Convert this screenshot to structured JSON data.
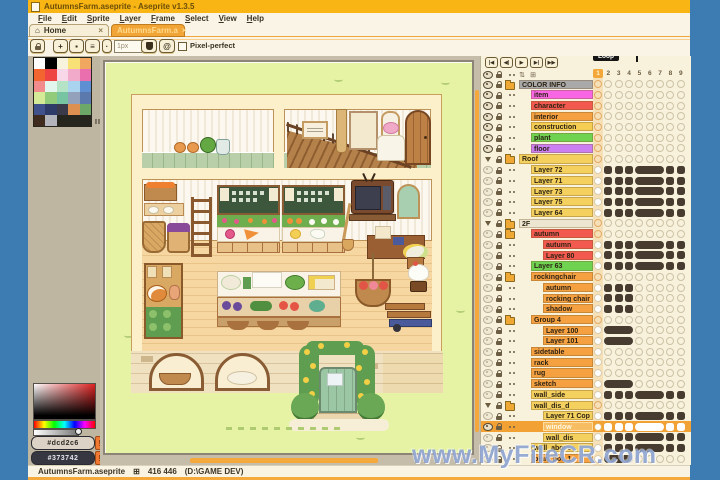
{
  "window": {
    "title": "AutumnsFarm.aseprite - Aseprite v1.3.5"
  },
  "menu": {
    "items": [
      "File",
      "Edit",
      "Sprite",
      "Layer",
      "Frame",
      "Select",
      "View",
      "Help"
    ]
  },
  "tabs": {
    "home_label": "Home",
    "home_icon": "⌂",
    "file_label": "AutumnsFarm.a",
    "close_glyph": "×"
  },
  "context_bar": {
    "brush_size_value": "1px",
    "pixel_perfect_label": "Pixel-perfect",
    "plus_glyph": "+",
    "square_glyph": "▪",
    "lines_glyph": "≡",
    "dot_glyph": "·",
    "dynamics_glyph": "@"
  },
  "palette": {
    "cursor_mark": "II",
    "colors": [
      "#ffffff",
      "#000000",
      "#f7f3dc",
      "#f8e277",
      "#f0a860",
      "#f26430",
      "#ee4444",
      "#f8d8e8",
      "#f2aacb",
      "#ea6fae",
      "#f28c8c",
      "#e2f6ee",
      "#b5e3c5",
      "#a9d3ef",
      "#5f8fd3",
      "#d4ea96",
      "#92cb7a",
      "#77c4a2",
      "#93a2ba",
      "#5b79ad",
      "#41518b",
      "#2e3a67",
      "#3a3a4b",
      "#de9050",
      "#6da868",
      "#3f2b1d",
      "#b4b4bc"
    ]
  },
  "color_picker": {
    "fg_button": "#dcd2c6",
    "bg_button": "#373742",
    "warning_glyph": "!"
  },
  "timeline": {
    "loop_label": "Loop",
    "frames": [
      "1",
      "2",
      "3",
      "4",
      "5",
      "6",
      "7",
      "8",
      "9"
    ],
    "playback": [
      "|◀",
      "◀|",
      "▶",
      "▶|",
      "▶▶"
    ],
    "header_icons": [
      "⇅",
      "⊞"
    ],
    "layers": [
      {
        "l": "COLOR INFO",
        "i": 0,
        "c": "#a9a9a9",
        "t": "f",
        "e": "d",
        "p": "L"
      },
      {
        "l": "item",
        "i": 1,
        "c": "#f966e3",
        "e": "d",
        "p": "L"
      },
      {
        "l": "character",
        "i": 1,
        "c": "#f2594f",
        "e": "d",
        "p": "L"
      },
      {
        "l": "interior",
        "i": 1,
        "c": "#f5a041",
        "e": "d",
        "p": "L"
      },
      {
        "l": "construction",
        "i": 1,
        "c": "#f4cd52",
        "e": "d",
        "p": "L"
      },
      {
        "l": "plant",
        "i": 1,
        "c": "#6fd250",
        "e": "d",
        "p": "L"
      },
      {
        "l": "floor",
        "i": 1,
        "c": "#cb7ff0",
        "e": "d",
        "p": "L"
      },
      {
        "l": "Roof",
        "i": 0,
        "c": "#f4d05e",
        "t": "f",
        "ch": 1,
        "e": "d",
        "p": "L"
      },
      {
        "l": "Layer 72",
        "i": 1,
        "c": "#f4d05e",
        "e": "l",
        "p": "A"
      },
      {
        "l": "Layer 71",
        "i": 1,
        "c": "#f4d05e",
        "e": "l",
        "p": "A"
      },
      {
        "l": "Layer 73",
        "i": 1,
        "c": "#f4d05e",
        "e": "l",
        "p": "A"
      },
      {
        "l": "Layer 75",
        "i": 1,
        "c": "#f4d05e",
        "e": "l",
        "p": "A"
      },
      {
        "l": "Layer 64",
        "i": 1,
        "c": "#f4d05e",
        "e": "l",
        "p": "A"
      },
      {
        "l": "2F",
        "i": 0,
        "c": "#ece5d0",
        "t": "f",
        "ch": 1,
        "e": "d",
        "p": "L"
      },
      {
        "l": "autumn",
        "i": 1,
        "c": "#f2594f",
        "t": "f",
        "e": "l",
        "p": "L"
      },
      {
        "l": "autumn",
        "i": 2,
        "c": "#f2594f",
        "e": "l",
        "p": "A"
      },
      {
        "l": "Layer 80",
        "i": 2,
        "c": "#f2594f",
        "e": "l",
        "p": "A"
      },
      {
        "l": "Layer 63",
        "i": 1,
        "c": "#6fd250",
        "e": "l",
        "p": "A"
      },
      {
        "l": "rockingchair",
        "i": 1,
        "c": "#f5a041",
        "t": "f",
        "e": "l",
        "p": "L"
      },
      {
        "l": "autumn",
        "i": 2,
        "c": "#f5a041",
        "e": "l",
        "p": "B"
      },
      {
        "l": "rocking chair",
        "i": 2,
        "c": "#f5a041",
        "e": "l",
        "p": "B"
      },
      {
        "l": "shadow",
        "i": 2,
        "c": "#f5a041",
        "e": "l",
        "p": "B"
      },
      {
        "l": "Group 4",
        "i": 1,
        "c": "#f5a041",
        "t": "f",
        "e": "l",
        "p": "L"
      },
      {
        "l": "Layer 100",
        "i": 2,
        "c": "#f5a041",
        "e": "l",
        "p": "C"
      },
      {
        "l": "Layer 101",
        "i": 2,
        "c": "#f5a041",
        "e": "l",
        "p": "C"
      },
      {
        "l": "sidetable",
        "i": 1,
        "c": "#f5a041",
        "e": "l",
        "p": "D"
      },
      {
        "l": "rack",
        "i": 1,
        "c": "#f5a041",
        "e": "l",
        "p": "D"
      },
      {
        "l": "rug",
        "i": 1,
        "c": "#f5a041",
        "e": "l",
        "p": "D"
      },
      {
        "l": "sketch",
        "i": 1,
        "c": "#f5a041",
        "e": "l",
        "p": "C"
      },
      {
        "l": "wall_side",
        "i": 1,
        "c": "#f4d05e",
        "e": "l",
        "p": "A"
      },
      {
        "l": "wall_dis_d",
        "i": 1,
        "c": "#f4d05e",
        "t": "f",
        "ch": 1,
        "e": "l",
        "p": "L"
      },
      {
        "l": "Layer 71 Cop",
        "i": 2,
        "c": "#f4d05e",
        "e": "l",
        "p": "A"
      },
      {
        "l": "window",
        "i": 2,
        "c": "#f4d05e",
        "e": "d",
        "p": "A",
        "sel": 1
      },
      {
        "l": "wall_dis",
        "i": 2,
        "c": "#f4d05e",
        "e": "l",
        "p": "A"
      },
      {
        "l": "wall_above",
        "i": 1,
        "c": "#f4d05e",
        "e": "l",
        "p": "A"
      },
      {
        "l": "plant pot_1",
        "i": 1,
        "c": "#f5a041",
        "e": "l",
        "p": "C"
      },
      {
        "l": "",
        "i": 1,
        "c": "#f5a041",
        "e": "l",
        "p": "C"
      }
    ]
  },
  "status_bar": {
    "filename": "AutumnsFarm.aseprite",
    "size_glyph": "⊞",
    "dimensions": "416 446",
    "path": "(D:\\GAME DEV)"
  },
  "watermark": {
    "text": "www.MyFileCR.com"
  },
  "ui_colors": {
    "desktop": "#3c7cb3",
    "titlebar": "#f9b513",
    "accent_orange": "#f2a63a",
    "cream": "#f9f4e5",
    "panel_tan": "#bfb6a2",
    "timeline_bg": "#f8f1dc",
    "canvas_green": "#e6f3a5",
    "selection_orange": "#f2a135",
    "cel_dot": "#473c2f",
    "scrollbar": "#f5a83c"
  }
}
